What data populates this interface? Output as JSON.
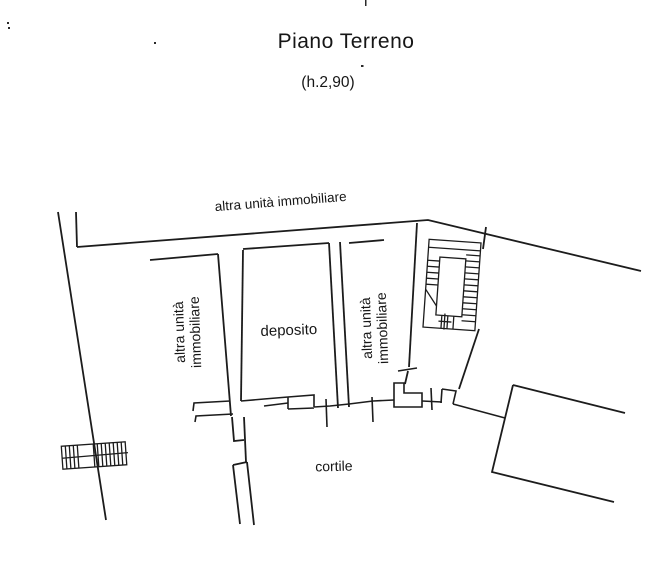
{
  "page": {
    "background": "#ffffff",
    "ink": "#1c1c1c"
  },
  "header": {
    "title": "Piano Terreno",
    "subtitle": "(h.2,90)"
  },
  "plan": {
    "labels": {
      "adjacent_unit_top": "altra unità immobiliare",
      "adjacent_unit_left_line1": "altra unità",
      "adjacent_unit_left_line2": "immobiliare",
      "adjacent_unit_right_line1": "altra unità",
      "adjacent_unit_right_line2": "immobiliare",
      "storage_room": "deposito",
      "courtyard": "cortile"
    }
  }
}
